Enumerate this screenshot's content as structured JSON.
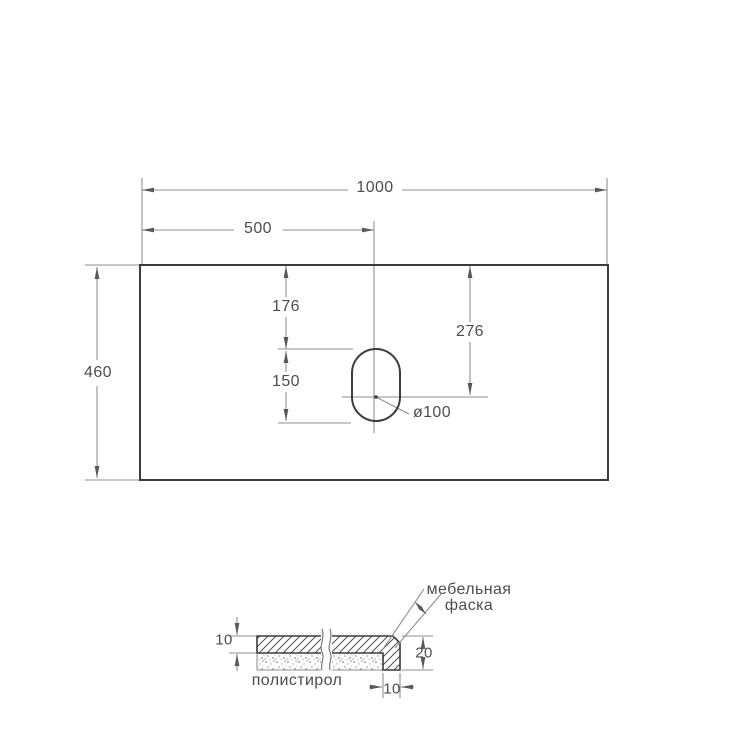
{
  "top_view": {
    "width": "1000",
    "hole_center_from_left": "500",
    "depth": "460",
    "hole_top_offset": "176",
    "hole_length": "150",
    "hole_center_offset": "276",
    "hole_diameter": "ø100"
  },
  "section_view": {
    "top_thickness": "10",
    "edge_height": "20",
    "edge_width": "10",
    "chamfer_label_line1": "мебельная",
    "chamfer_label_line2": "фаска",
    "filler_material": "полистирол"
  },
  "colors": {
    "outline": "#3b3b3b",
    "dim_line": "#8f8f8f",
    "arrow": "#595959",
    "text": "#4d4d4d",
    "background": "#ffffff"
  }
}
